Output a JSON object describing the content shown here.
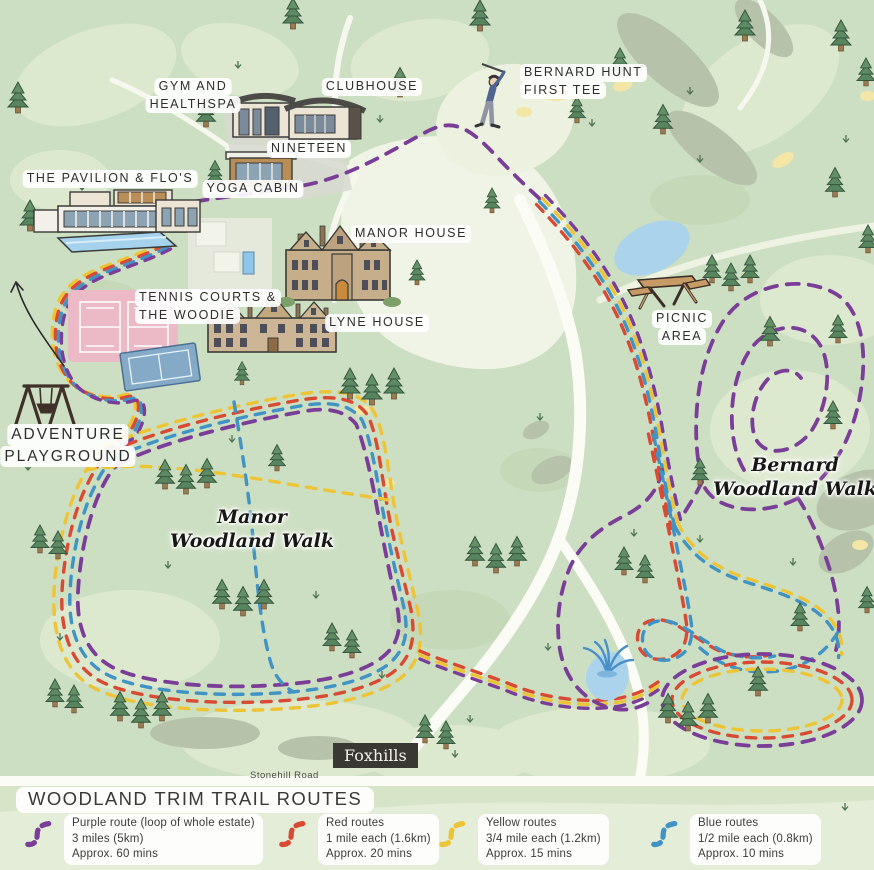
{
  "map": {
    "labels": {
      "gym_healthspa": [
        "GYM AND",
        "HEALTHSPA"
      ],
      "clubhouse": "CLUBHOUSE",
      "nineteen": "NINETEEN",
      "yoga_cabin": "YOGA CABIN",
      "pavilion": "THE PAVILION & FLO'S",
      "bernard_hunt_tee": [
        "BERNARD HUNT",
        "FIRST TEE"
      ],
      "manor_house": "MANOR HOUSE",
      "tennis_woodie": [
        "TENNIS COURTS &",
        "THE WOODIE"
      ],
      "lyne_house": "LYNE HOUSE",
      "picnic_area": [
        "PICNIC",
        "AREA"
      ],
      "adventure_playground": [
        "ADVENTURE",
        "PLAYGROUND"
      ],
      "manor_walk": [
        "Manor",
        "Woodland Walk"
      ],
      "bernard_walk": [
        "Bernard",
        "Woodland Walk"
      ]
    },
    "badge": "Foxhills",
    "road": "Stonehill Road"
  },
  "legend": {
    "title": "WOODLAND TRIM TRAIL ROUTES",
    "items": [
      {
        "name": "purple",
        "color": "#7b3e98",
        "lines": [
          "Purple route (loop of whole estate)",
          "3 miles (5km)",
          "Approx. 60 mins"
        ]
      },
      {
        "name": "red",
        "color": "#d94a33",
        "lines": [
          "Red routes",
          "1 mile each (1.6km)",
          "Approx. 20 mins"
        ]
      },
      {
        "name": "yellow",
        "color": "#eec437",
        "lines": [
          "Yellow routes",
          "3/4 mile each (1.2km)",
          "Approx. 15 mins"
        ]
      },
      {
        "name": "blue",
        "color": "#4093c4",
        "lines": [
          "Blue routes",
          "1/2 mile each (0.8km)",
          "Approx. 10 mins"
        ]
      }
    ]
  },
  "route_colors": {
    "purple": "#7b3e98",
    "red": "#d94a33",
    "yellow": "#eec437",
    "blue": "#4093c4"
  }
}
